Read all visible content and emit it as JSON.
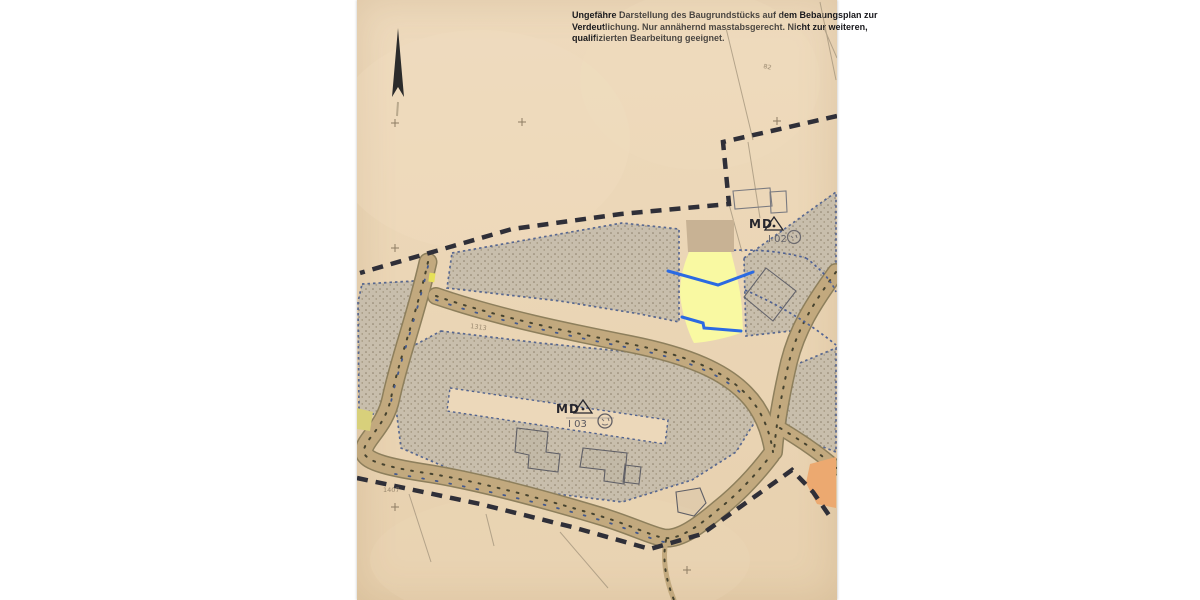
{
  "scan": {
    "disclaimer_lines": [
      "Ungefähre Darstellung des Baugrundstücks auf dem Bebaungsplan zur",
      "Verdeutlichung. Nur annähernd masstabsgerecht. Nicht zur weiteren,",
      "qualifizierten Bearbeitung geeignet."
    ],
    "zones": {
      "upper": {
        "use": "MD",
        "ref": "I 02"
      },
      "lower": {
        "use": "MD",
        "ref": "I 03"
      }
    },
    "parcel_numbers": {
      "a": "1407",
      "b": "1313",
      "c": "82"
    },
    "colors": {
      "paper": "#ecd8ba",
      "parcel_hatch_base": "#c7bdac",
      "parcel_outline_blue": "#51628e",
      "road_fill": "#c2a97e",
      "road_casing": "#8d7f5c",
      "boundary_dash": "#2f2f38",
      "highlight_parcel_yellow": "#f9f9a2",
      "highlight_line_blue": "#2b6ae2",
      "masked_area_tan": "#c8b294",
      "orange_parcel": "#eca970",
      "small_green_patch": "#d8d07b"
    }
  }
}
